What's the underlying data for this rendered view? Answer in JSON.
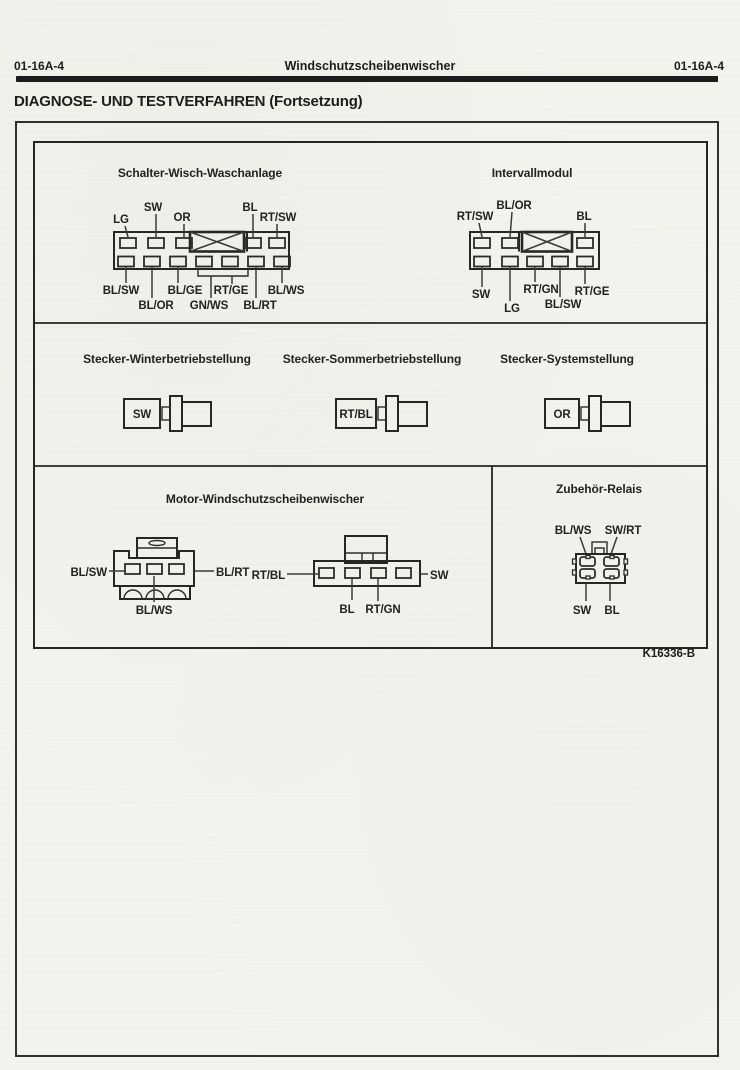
{
  "page": {
    "header_left": "01-16A-4",
    "header_center": "Windschutzscheibenwischer",
    "header_right": "01-16A-4",
    "heading": "DIAGNOSE- UND TESTVERFAHREN (Fortsetzung)",
    "figure_code": "K16336-B"
  },
  "figure": {
    "schalter": {
      "title": "Schalter-Wisch-Waschanlage",
      "top": [
        "LG",
        "SW",
        "OR",
        "BL",
        "RT/SW"
      ],
      "bottom": [
        "BL/SW",
        "BL/OR",
        "BL/GE",
        "GN/WS",
        "RT/GE",
        "BL/RT",
        "BL/WS"
      ]
    },
    "intervall": {
      "title": "Intervallmodul",
      "top": [
        "RT/SW",
        "BL/OR",
        "BL"
      ],
      "bottom": [
        "SW",
        "LG",
        "RT/GN",
        "BL/SW",
        "RT/GE"
      ]
    },
    "winter": {
      "title": "Stecker-Winterbetriebstellung",
      "wire": "SW"
    },
    "sommer": {
      "title": "Stecker-Sommerbetriebstellung",
      "wire": "RT/BL"
    },
    "system": {
      "title": "Stecker-Systemstellung",
      "wire": "OR"
    },
    "motor": {
      "title": "Motor-Windschutzscheibenwischer",
      "a_left": "BL/SW",
      "a_right": "BL/RT",
      "a_bottom": "BL/WS",
      "b_left": "RT/BL",
      "b_right": "SW",
      "b_bottom1": "BL",
      "b_bottom2": "RT/GN"
    },
    "relais": {
      "title": "Zubehör-Relais",
      "top_left": "BL/WS",
      "top_right": "SW/RT",
      "bottom_left": "SW",
      "bottom_right": "BL"
    }
  }
}
